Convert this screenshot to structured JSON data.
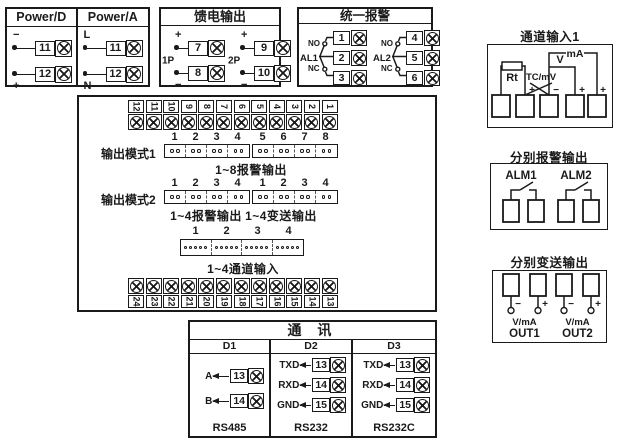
{
  "colors": {
    "ink": "#1a1a1a",
    "bg": "#ffffff"
  },
  "power_d": {
    "title": "Power/D",
    "rows": [
      {
        "sign": "−",
        "num": "11"
      },
      {
        "sign": "+",
        "num": "12"
      }
    ]
  },
  "power_a": {
    "title": "Power/A",
    "rows": [
      {
        "sign": "L",
        "num": "11"
      },
      {
        "sign": "N",
        "num": "12"
      }
    ]
  },
  "feed_output": {
    "title": "馈电输出",
    "groups": [
      {
        "name": "1P",
        "rows": [
          {
            "sign": "+",
            "num": "7"
          },
          {
            "sign": "−",
            "num": "8"
          }
        ]
      },
      {
        "name": "2P",
        "rows": [
          {
            "sign": "+",
            "num": "9"
          },
          {
            "sign": "−",
            "num": "10"
          }
        ]
      }
    ]
  },
  "unified_alarm": {
    "title": "统一报警",
    "relays": [
      {
        "name": "AL1",
        "no_label": "NO",
        "nc_label": "NC",
        "terminals": [
          "1",
          "2",
          "3"
        ]
      },
      {
        "name": "AL2",
        "no_label": "NO",
        "nc_label": "NC",
        "terminals": [
          "4",
          "5",
          "6"
        ]
      }
    ]
  },
  "main_unit": {
    "top_strip": [
      "12",
      "11",
      "10",
      "9",
      "8",
      "7",
      "6",
      "5",
      "4",
      "3",
      "2",
      "1"
    ],
    "bottom_strip": [
      "24",
      "23",
      "22",
      "21",
      "20",
      "19",
      "18",
      "17",
      "16",
      "15",
      "14",
      "13"
    ],
    "output_mode1": {
      "label": "输出模式1",
      "numbers": [
        "1",
        "2",
        "3",
        "4",
        "5",
        "6",
        "7",
        "8"
      ],
      "caption": "1~8报警输出"
    },
    "output_mode2": {
      "label": "输出模式2",
      "numbers": [
        "1",
        "2",
        "3",
        "4",
        "1",
        "2",
        "3",
        "4"
      ],
      "caption_left": "1~4报警输出",
      "caption_right": "1~4变送输出"
    },
    "channel_jumper": {
      "numbers": [
        "1",
        "2",
        "3",
        "4"
      ],
      "caption": "1~4通道输入"
    }
  },
  "channel_input1": {
    "title": "通道输入1",
    "rt": "Rt",
    "tc": "TC/mV",
    "v": "V",
    "ma": "mA",
    "signs": [
      "+",
      "−",
      "+",
      "+"
    ]
  },
  "separate_alarm": {
    "title": "分别报警输出",
    "items": [
      "ALM1",
      "ALM2"
    ]
  },
  "separate_transmit": {
    "title": "分别变送输出",
    "outputs": [
      {
        "minus": "−",
        "plus": "+",
        "vma": "V/mA",
        "name": "OUT1"
      },
      {
        "minus": "−",
        "plus": "+",
        "vma": "V/mA",
        "name": "OUT2"
      }
    ]
  },
  "comm": {
    "title": "通 讯",
    "columns": [
      {
        "header": "D1",
        "rows": [
          {
            "label": "A",
            "num": "13"
          },
          {
            "label": "B",
            "num": "14"
          }
        ],
        "footer": "RS485"
      },
      {
        "header": "D2",
        "rows": [
          {
            "label": "TXD",
            "num": "13"
          },
          {
            "label": "RXD",
            "num": "14"
          },
          {
            "label": "GND",
            "num": "15"
          }
        ],
        "footer": "RS232"
      },
      {
        "header": "D3",
        "rows": [
          {
            "label": "TXD",
            "num": "13"
          },
          {
            "label": "RXD",
            "num": "14"
          },
          {
            "label": "GND",
            "num": "15"
          }
        ],
        "footer": "RS232C"
      }
    ]
  }
}
